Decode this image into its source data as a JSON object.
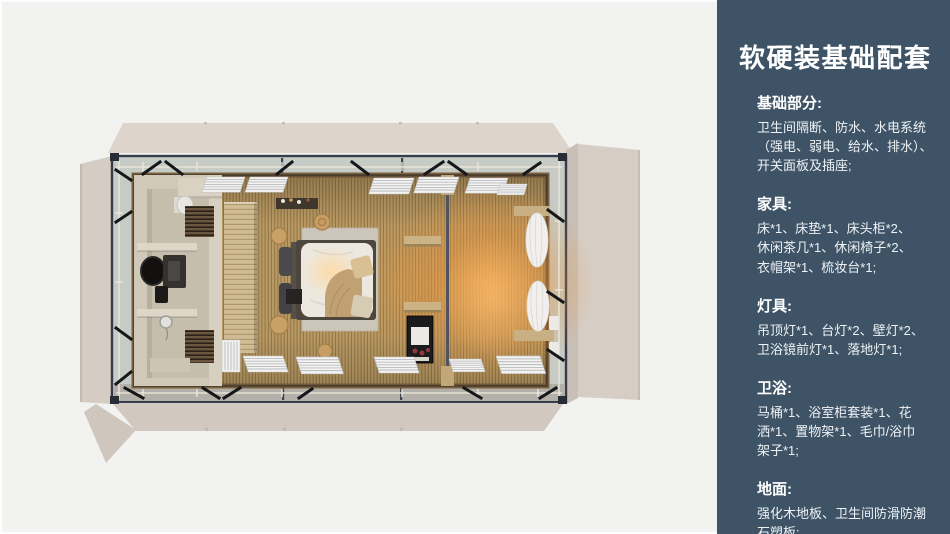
{
  "sidebar": {
    "background": "#3e5466",
    "title": "软硬装基础配套",
    "sections": [
      {
        "heading": "基础部分:",
        "body": "卫生间隔断、防水、水电系统\n（强电、弱电、给水、排水）、\n开关面板及插座;"
      },
      {
        "heading": "家具:",
        "body": "床*1、床垫*1、床头柜*2、\n休闲茶几*1、休闲椅子*2、\n衣帽架*1、梳妆台*1;"
      },
      {
        "heading": "灯具:",
        "body": "吊顶灯*1、台灯*2、壁灯*2、\n卫浴镜前灯*1、落地灯*1;"
      },
      {
        "heading": "卫浴:",
        "body": "马桶*1、浴室柜套装*1、花\n洒*1、置物架*1、毛巾/浴巾\n架子*1;"
      },
      {
        "heading": "地面:",
        "body": "强化木地板、卫生间防滑防潮\n石塑板;"
      }
    ]
  },
  "floorplan": {
    "palette": {
      "canvas_background": "#f2f3f1",
      "container_shell": "#d6cdc4",
      "steel_frame": "#363c48",
      "glass_band": "#c6cbc5",
      "wood_floor": "#b99a63",
      "warm_light": "#f0a050",
      "bathroom_stone": "#d0c9ba",
      "bedding": "#ece8e0"
    },
    "render_features": [
      "container-shell-flaps",
      "steel-frame",
      "glass-band",
      "wood-slat-floor",
      "bathroom",
      "toilet",
      "vanity-mirror",
      "shower",
      "towel-racks",
      "wardrobe",
      "bed",
      "rug",
      "pillows",
      "blanket",
      "side-stools",
      "wall-shelf",
      "open-shelves",
      "display-cabinet",
      "curtains",
      "ceiling-panels",
      "warm-lamp-glow"
    ]
  }
}
